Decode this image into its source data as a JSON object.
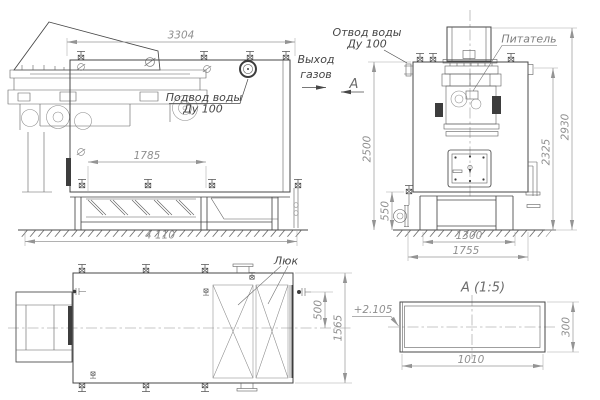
{
  "palette": {
    "main_line": "#474747",
    "detail_line": "#5f5f5f",
    "dimension": "#8f8f8f",
    "label": "#454545",
    "background": "#ffffff"
  },
  "side_view": {
    "dim_top_width": "3304",
    "dim_grate_length": "1785",
    "dim_overall_length": "4 110",
    "label_water_inlet_1": "Подвод воды",
    "label_water_inlet_2": "Ду 100",
    "label_gas_outlet_1": "Выход",
    "label_gas_outlet_2": "газов",
    "label_section_arrow": "А"
  },
  "front_view": {
    "dim_shell_height": "2500",
    "dim_base_height": "550",
    "dim_flange_height": "2325",
    "dim_overall_height": "2930",
    "dim_base_width": "1300",
    "dim_base_overall_width": "1755",
    "label_water_outlet_1": "Отвод воды",
    "label_water_outlet_2": "Ду 100",
    "label_feeder": "Питатель"
  },
  "plan_view": {
    "dim_nozzle_offset": "500",
    "dim_overall_width": "1565",
    "label_hatch": "Люк"
  },
  "section_view": {
    "title": "А (1:5)",
    "label_level_mark": "+2.105",
    "dim_width": "1010",
    "dim_height": "300"
  }
}
